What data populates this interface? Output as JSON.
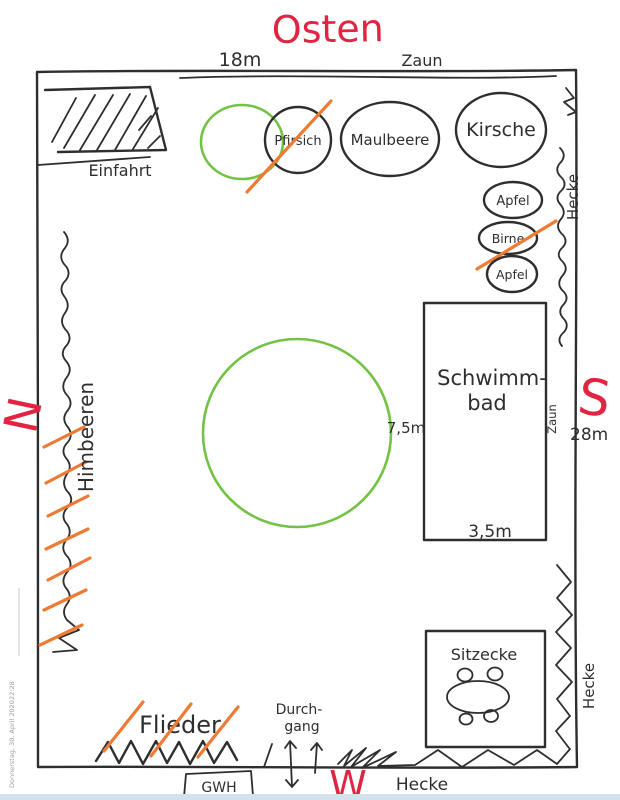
{
  "compass": {
    "east": "Osten",
    "north": "N",
    "south": "S",
    "west": "W"
  },
  "dimensions": {
    "width_top": "18m",
    "height_right": "28m",
    "pool_width": "3,5m",
    "lawn_diameter": "7,5m"
  },
  "boundaries": {
    "fence_top": "Zaun",
    "fence_pool": "Zaun",
    "hedge_right_top": "Hecke",
    "hedge_right_bottom": "Hecke",
    "hedge_bottom": "Hecke"
  },
  "areas": {
    "driveway": "Einfahrt",
    "pool_line1": "Schwimm-",
    "pool_line2": "bad",
    "seating": "Sitzecke",
    "passage_line1": "Durch-",
    "passage_line2": "gang",
    "greenhouse": "GWH"
  },
  "plants": {
    "peach": "Pfirsich",
    "mulberry": "Maulbeere",
    "cherry": "Kirsche",
    "apple_top": "Apfel",
    "pear": "Birne",
    "apple_bottom": "Apfel",
    "raspberries": "Himbeeren",
    "lilac": "Flieder"
  },
  "sidebar": {
    "date": "Donnerstag, 30. April 2020",
    "time": "22:28"
  },
  "colors": {
    "ink": "#2e2e2e",
    "red": "#e02441",
    "orange": "#ee7b33",
    "green": "#72c245",
    "timestamp": "#9aa0a6",
    "footer_strip": "#d3e2ec"
  }
}
